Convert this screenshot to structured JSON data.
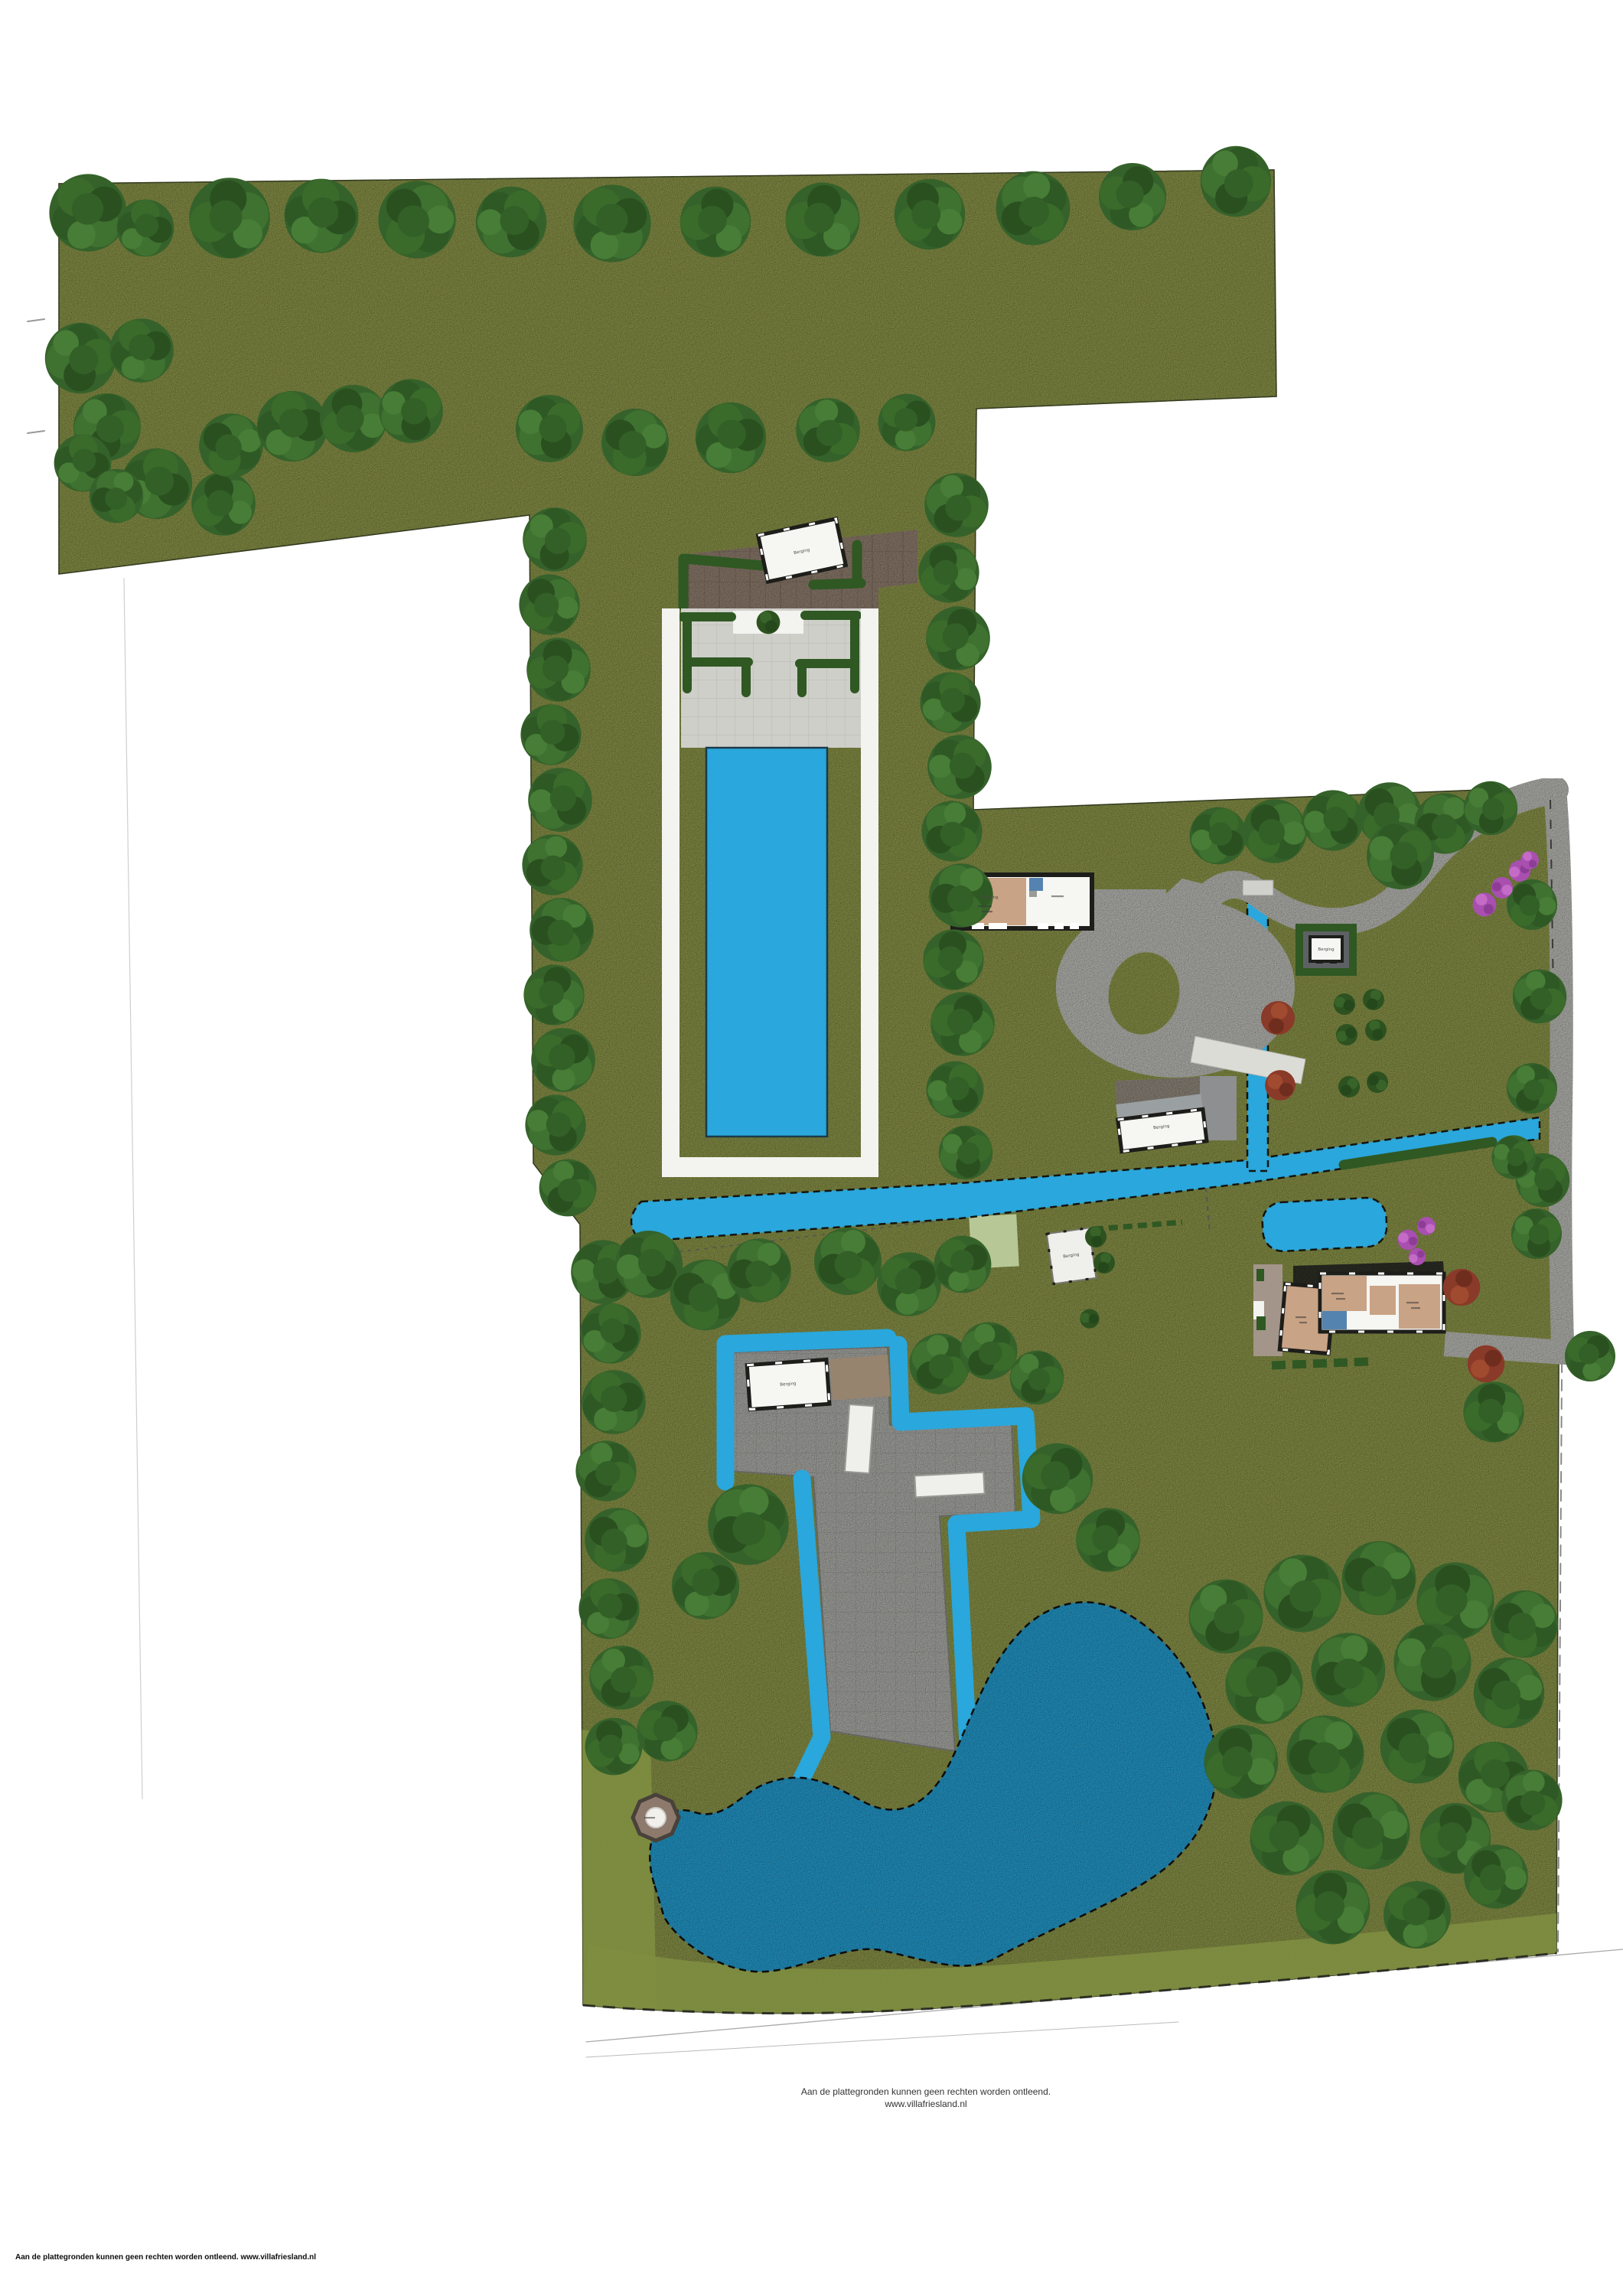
{
  "map": {
    "building_labels": {
      "pool_house": "Berging",
      "barn_room": "Berging",
      "garden_shed": "Berging",
      "field_barn": "Berging",
      "island_house": "Berging",
      "garden_structure": "Berging"
    },
    "footer": {
      "disclaimer_line1": "Aan de plattegronden kunnen geen rechten worden ontleend.",
      "disclaimer_line2": "www.villafriesland.nl",
      "bottom_disclaimer": "Aan de plattegronden kunnen geen rechten worden ontleend. www.villafriesland.nl"
    },
    "colors": {
      "grass": "#96a050",
      "grass_dark": "#7e8d40",
      "foliage": "#3a6b2b",
      "water": "#2aa7dc",
      "gravel": "#c8c8c3",
      "gravel_light": "#dcdcd7",
      "terrace": "#cfcfca",
      "white_path": "#f3f3f0",
      "courtyard": "#9b8878",
      "building_tan": "#c9a385",
      "wall": "#1d1d1a",
      "roof": "#2e2e2a",
      "paved": "#b9b9b5",
      "pad_dark": "#5e6163",
      "brown": "#97846f",
      "room_blue": "#5583b0",
      "hedge": "#2f5823",
      "purple": "#b554ba",
      "red_tree": "#8f3b28",
      "light_patch": "#b7c795"
    }
  }
}
